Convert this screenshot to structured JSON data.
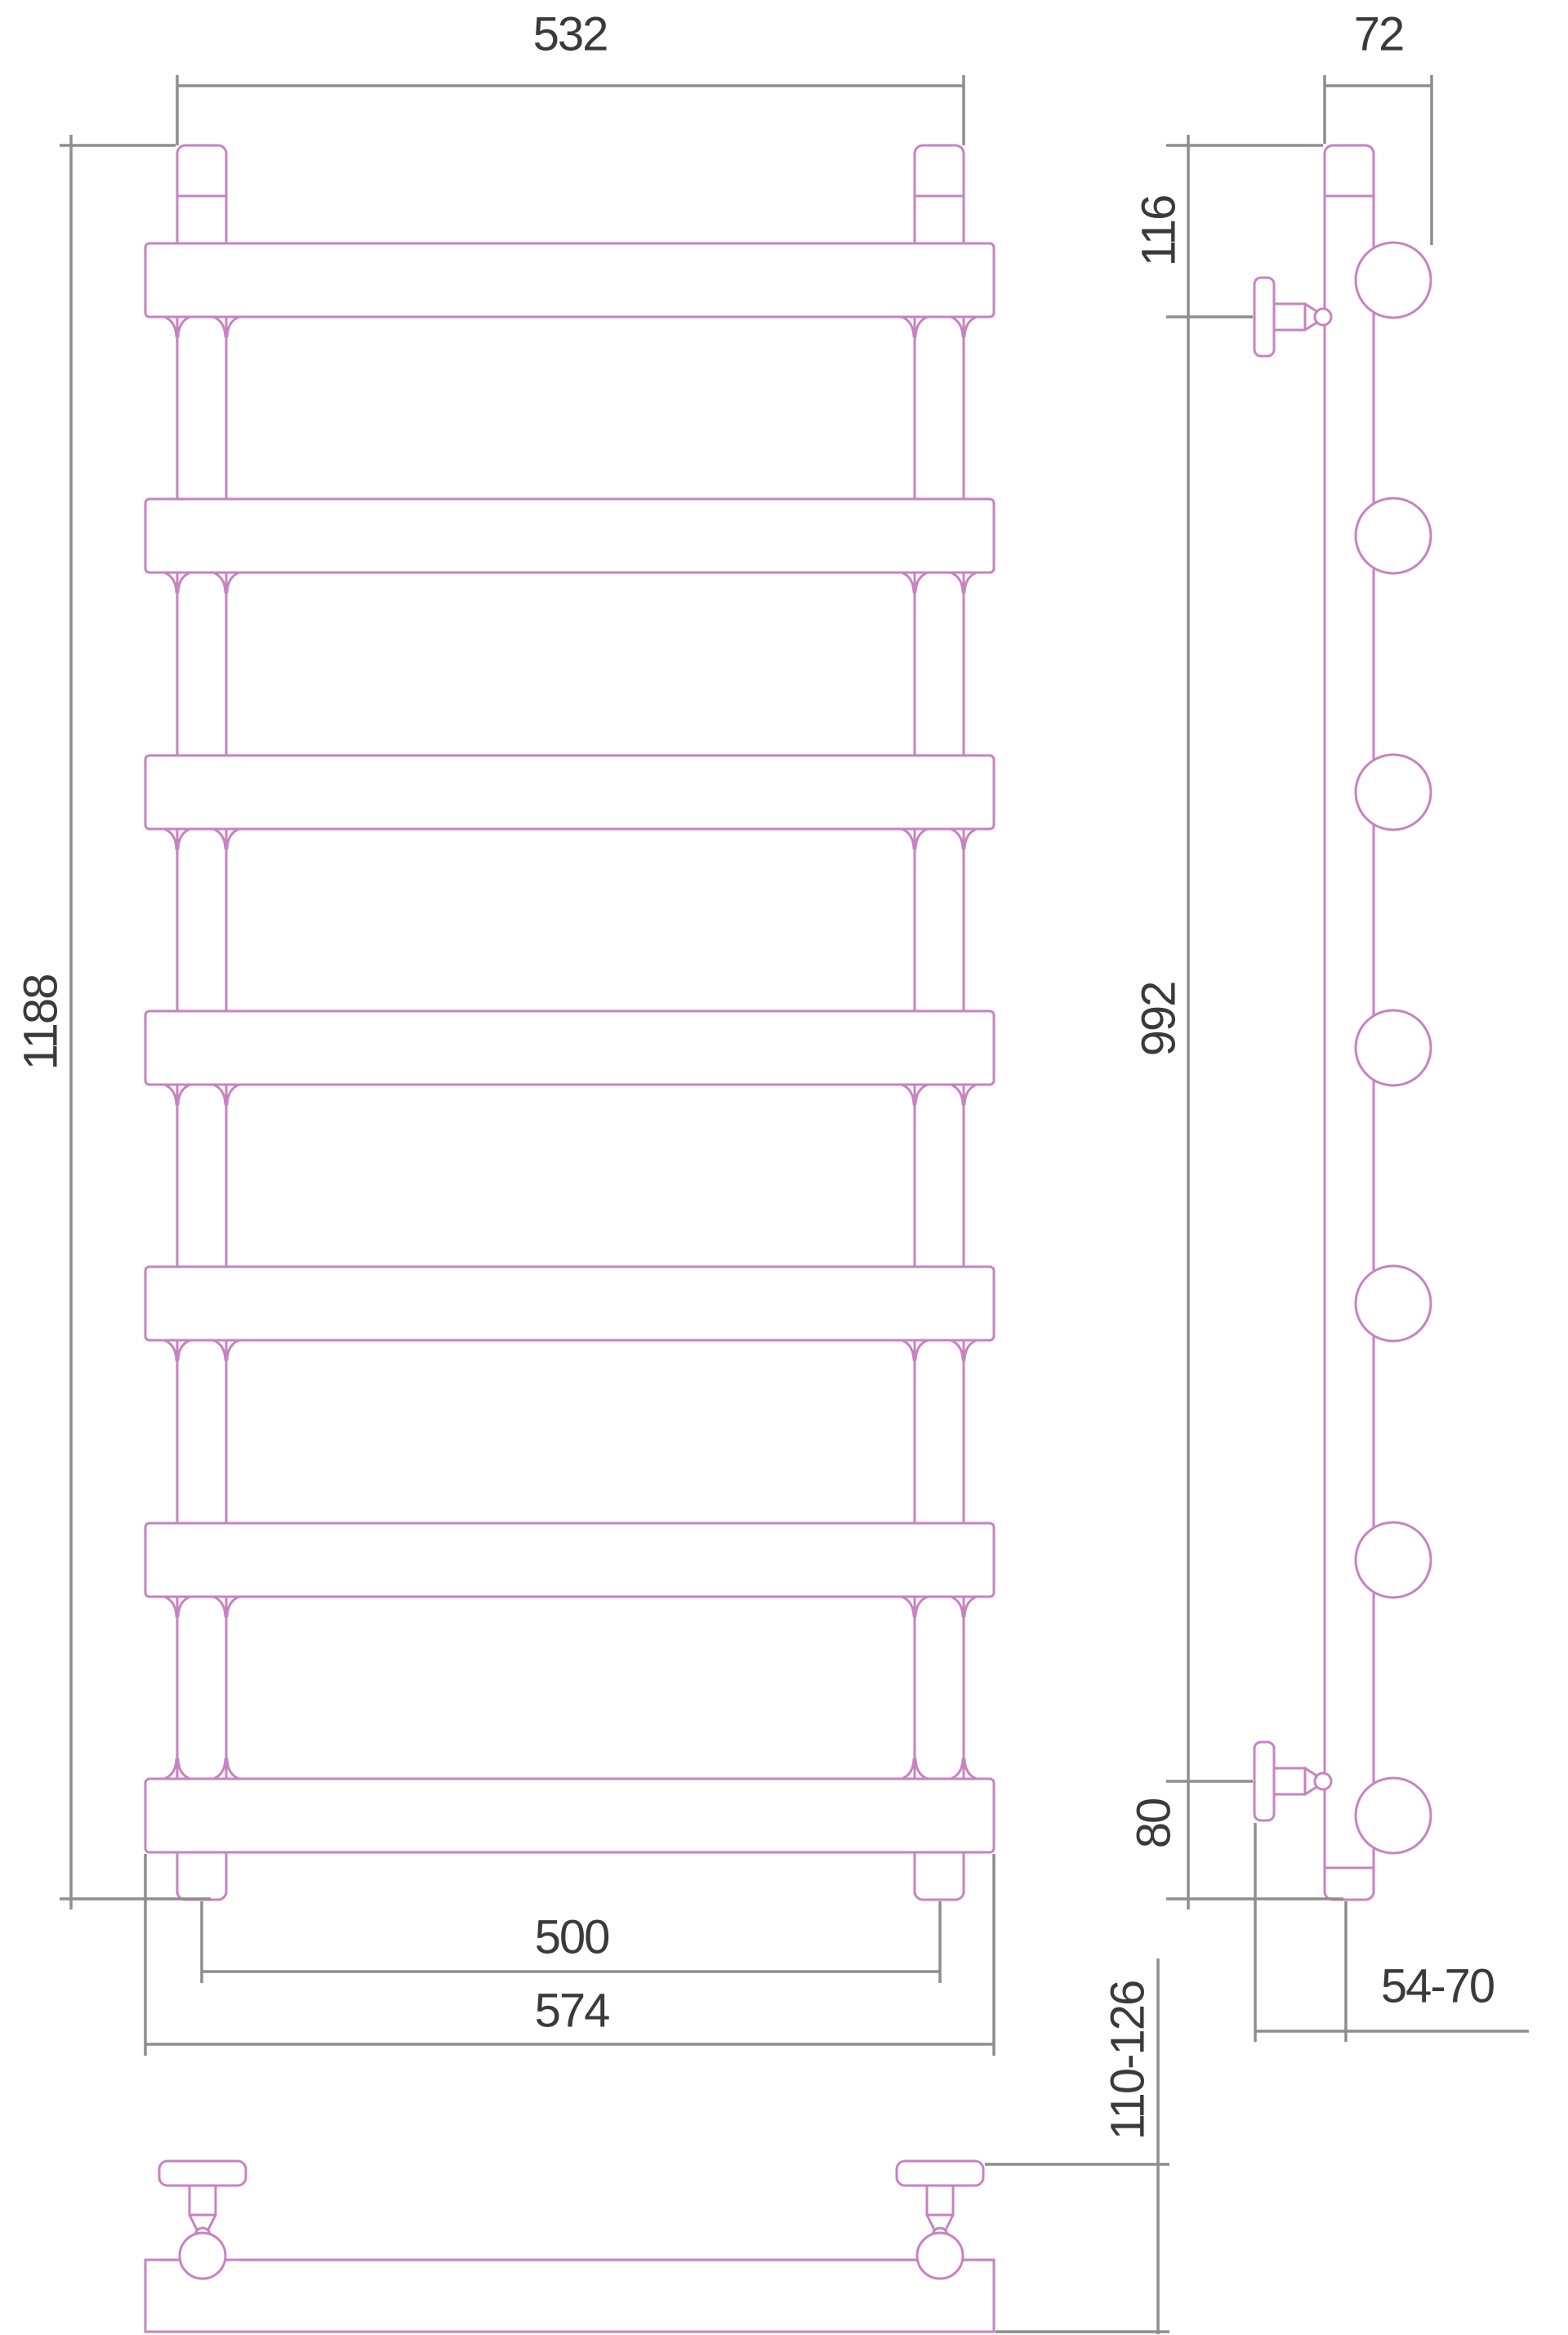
{
  "drawing": {
    "views": {
      "front": {
        "label_overall_width": "532",
        "label_overall_height": "1188",
        "label_mount_width": "500",
        "label_bar_length": "574"
      },
      "side": {
        "label_depth": "72",
        "label_top_to_bracket": "116",
        "label_bracket_span": "992",
        "label_bracket_to_bottom": "80",
        "label_wall_to_rail": "54-70"
      },
      "bottom": {
        "label_wall_to_front": "110-126"
      }
    },
    "colors": {
      "product": "#c783c1",
      "dimension": "#8e8e8e",
      "label": "#3a3a3a",
      "background": "#ffffff"
    }
  }
}
